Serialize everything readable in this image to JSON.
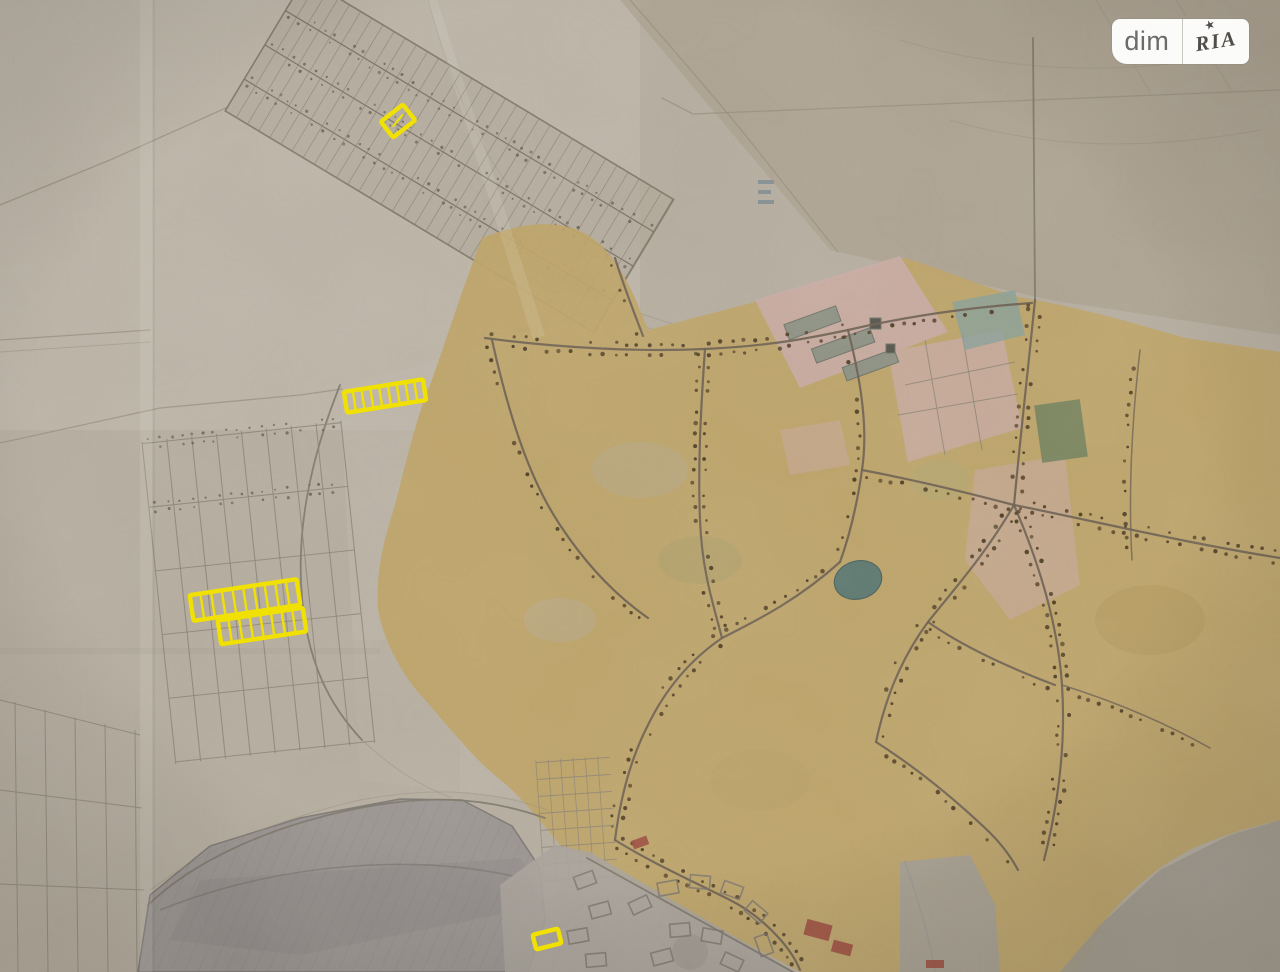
{
  "image": {
    "kind": "photo-of-paper-cadastral-map",
    "width": 1280,
    "height": 972
  },
  "watermark": {
    "left_label": "dim",
    "right_label": "RIA",
    "star_icon": "★"
  },
  "map": {
    "highlight_color": "#f0e103",
    "highlights": [
      {
        "id": "plot-north",
        "parts": [
          {
            "cx": 398,
            "cy": 121,
            "w": 28,
            "h": 20,
            "rotate": -38,
            "cells": 1,
            "tick": true
          }
        ]
      },
      {
        "id": "strip-west",
        "parts": [
          {
            "cx": 385,
            "cy": 396,
            "w": 80,
            "h": 21,
            "rotate": -9,
            "cells": 9
          }
        ]
      },
      {
        "id": "block-southwest",
        "parts": [
          {
            "cx": 245,
            "cy": 600,
            "w": 108,
            "h": 26,
            "rotate": -8.5,
            "cells": 10
          },
          {
            "cx": 262,
            "cy": 626,
            "w": 86,
            "h": 24,
            "rotate": -8.5,
            "cells": 8
          }
        ]
      },
      {
        "id": "plot-south",
        "parts": [
          {
            "cx": 547,
            "cy": 939,
            "w": 26,
            "h": 15,
            "rotate": -14,
            "cells": 1
          }
        ]
      }
    ],
    "palette": {
      "paper": "#b6aea0",
      "paper-light": "#c3bcae",
      "paper-dark": "#a89c8a",
      "ochre": "#bfa466",
      "road": "#6d6051",
      "dot": "#4f3e24",
      "line-field": "#968e7d",
      "line-grid": "#8a8274",
      "pink": "#c9aba5",
      "green": "#70805c",
      "teal": "#5e7a72",
      "water": "#9a9592",
      "water-line": "#7c7772",
      "planned": "#a9a39b",
      "block": "#7e776e",
      "red": "#9c4a3d",
      "highlight": "#f0e103",
      "wm-bg": "#fbfbf9",
      "wm-dim": "#6b6b69",
      "wm-ria": "#514d48",
      "wm-divider": "#c9c6c0"
    }
  }
}
